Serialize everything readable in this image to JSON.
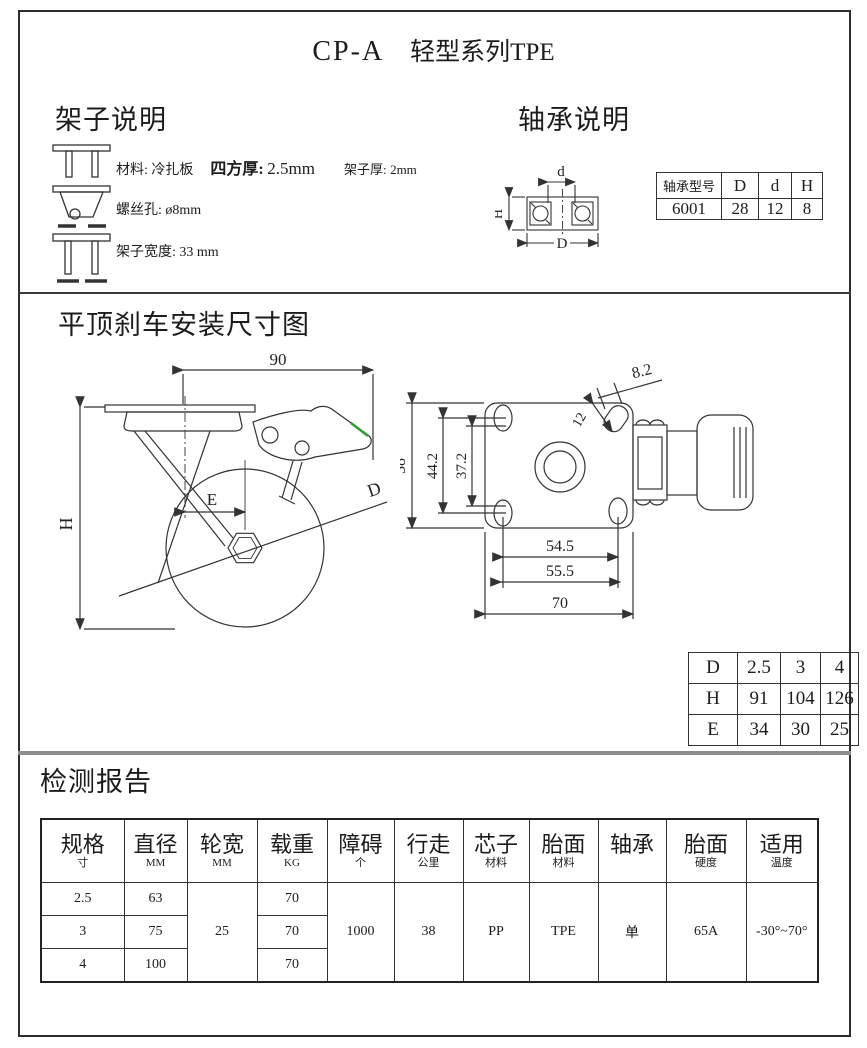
{
  "colors": {
    "line": "#333333",
    "divider_gray": "#8c8c8c",
    "accent_green": "#2f9e2f"
  },
  "page": {
    "title_code": "CP-A",
    "title_series": "轻型系列TPE"
  },
  "frame": {
    "heading": "架子说明",
    "line1": {
      "material": "材料: 冷扎板",
      "square_label": "四方厚:",
      "square_value": "2.5mm",
      "thick_label": "架子厚:",
      "thick_value": "2mm"
    },
    "line2": {
      "label": "螺丝孔:",
      "value": "ø8mm"
    },
    "line3": {
      "label": "架子宽度:",
      "value": "33 mm"
    }
  },
  "bearing": {
    "heading": "轴承说明",
    "diagram": {
      "d": "d",
      "D": "D",
      "H": "H"
    },
    "table": {
      "headers": [
        "轴承型号",
        "D",
        "d",
        "H"
      ],
      "values": [
        "6001",
        "28",
        "12",
        "8"
      ]
    }
  },
  "drawing": {
    "heading": "平顶刹车安装尺寸图",
    "side": {
      "top_width": "90",
      "height_label": "H",
      "offset_label": "E",
      "dia_label": "D"
    },
    "top": {
      "plate_h": "58",
      "holes_v_outer": "44.2",
      "holes_v_inner": "37.2",
      "holes_h": "54.5",
      "holes_h2": "55.5",
      "plate_w": "70",
      "slot_len": "12",
      "slot_w": "8.2"
    },
    "dhe": {
      "rows": [
        {
          "label": "D",
          "v": [
            "2.5",
            "3",
            "4"
          ]
        },
        {
          "label": "H",
          "v": [
            "91",
            "104",
            "126"
          ]
        },
        {
          "label": "E",
          "v": [
            "34",
            "30",
            "25"
          ]
        }
      ]
    }
  },
  "report": {
    "heading": "检测报告",
    "cols": [
      {
        "t": "规格",
        "u": "寸"
      },
      {
        "t": "直径",
        "u": "MM"
      },
      {
        "t": "轮宽",
        "u": "MM"
      },
      {
        "t": "载重",
        "u": "KG"
      },
      {
        "t": "障碍",
        "u": "个"
      },
      {
        "t": "行走",
        "u": "公里"
      },
      {
        "t": "芯子",
        "u": "材料"
      },
      {
        "t": "胎面",
        "u": "材料"
      },
      {
        "t": "轴承",
        "u": ""
      },
      {
        "t": "胎面",
        "u": "硬度"
      },
      {
        "t": "适用",
        "u": "温度"
      }
    ],
    "rows": [
      {
        "size": "2.5",
        "dia": "63",
        "load": "70"
      },
      {
        "size": "3",
        "dia": "75",
        "load": "70"
      },
      {
        "size": "4",
        "dia": "100",
        "load": "70"
      }
    ],
    "merged": {
      "wheel_width": "25",
      "obstacle": "1000",
      "distance": "38",
      "core": "PP",
      "tread": "TPE",
      "bearing": "单",
      "hardness": "65A",
      "temperature": "-30°~70°"
    }
  }
}
